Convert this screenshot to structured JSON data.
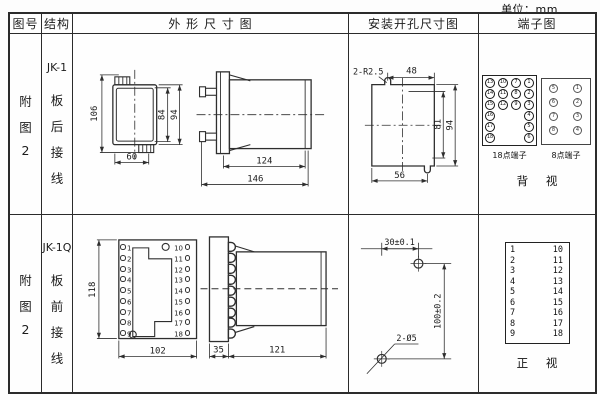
{
  "unit_note": "单位：mm",
  "colors": {
    "line": "#2b2b2b",
    "paper": "#fdfdfd"
  },
  "header": {
    "fig": "图号",
    "structure": "结构",
    "outline": "外 形 尺 寸 图",
    "mounting": "安装开孔尺寸图",
    "terminal": "端子图"
  },
  "rows": [
    {
      "fig_no": [
        "附",
        "图",
        "2"
      ],
      "structure": [
        "JK-1",
        "板",
        "后",
        "接",
        "线"
      ],
      "outline_dims": {
        "total_h": "106",
        "inner_h": "84",
        "outer_h": "94",
        "width": "60",
        "body_len": "124",
        "total_len": "146"
      },
      "mount_dims": {
        "notch": "2-R2.5",
        "top_w": "48",
        "inner_h": "81",
        "outer_h": "94",
        "bottom_w": "56"
      },
      "terminals18": {
        "caption": "18点端子",
        "items": [
          {
            "label": "13",
            "x": 6,
            "y": 44
          },
          {
            "label": "10",
            "x": 19,
            "y": 44
          },
          {
            "label": "7",
            "x": 32,
            "y": 44
          },
          {
            "label": "1",
            "x": 45,
            "y": 44
          },
          {
            "label": "14",
            "x": 6,
            "y": 55
          },
          {
            "label": "11",
            "x": 19,
            "y": 55
          },
          {
            "label": "8",
            "x": 32,
            "y": 55
          },
          {
            "label": "2",
            "x": 45,
            "y": 55
          },
          {
            "label": "15",
            "x": 6,
            "y": 66
          },
          {
            "label": "12",
            "x": 19,
            "y": 66
          },
          {
            "label": "9",
            "x": 32,
            "y": 66
          },
          {
            "label": "3",
            "x": 45,
            "y": 66
          },
          {
            "label": "16",
            "x": 6,
            "y": 77
          },
          {
            "label": "4",
            "x": 45,
            "y": 77
          },
          {
            "label": "17",
            "x": 6,
            "y": 88
          },
          {
            "label": "5",
            "x": 45,
            "y": 88
          },
          {
            "label": "18",
            "x": 6,
            "y": 99
          },
          {
            "label": "6",
            "x": 45,
            "y": 99
          }
        ]
      },
      "terminals8": {
        "caption": "8点端子",
        "items": [
          {
            "label": "5",
            "x": 70,
            "y": 50
          },
          {
            "label": "1",
            "x": 94,
            "y": 50
          },
          {
            "label": "6",
            "x": 70,
            "y": 64
          },
          {
            "label": "2",
            "x": 94,
            "y": 64
          },
          {
            "label": "7",
            "x": 70,
            "y": 78
          },
          {
            "label": "3",
            "x": 94,
            "y": 78
          },
          {
            "label": "8",
            "x": 70,
            "y": 92
          },
          {
            "label": "4",
            "x": 94,
            "y": 92
          }
        ]
      },
      "view_label": "背 视"
    },
    {
      "fig_no": [
        "附",
        "图",
        "2"
      ],
      "structure": [
        "JK-1Q",
        "板",
        "前",
        "接",
        "线"
      ],
      "outline_dims": {
        "height": "118",
        "width": "102",
        "flange": "35",
        "body_len": "121"
      },
      "front_left_terms": [
        {
          "label": "1",
          "x": 47,
          "y": 29
        },
        {
          "label": "2",
          "x": 47,
          "y": 40
        },
        {
          "label": "3",
          "x": 47,
          "y": 51
        },
        {
          "label": "4",
          "x": 47,
          "y": 61
        },
        {
          "label": "5",
          "x": 47,
          "y": 72
        },
        {
          "label": "6",
          "x": 47,
          "y": 83
        },
        {
          "label": "7",
          "x": 47,
          "y": 94
        },
        {
          "label": "8",
          "x": 47,
          "y": 104
        },
        {
          "label": "9",
          "x": 47,
          "y": 115
        }
      ],
      "front_right_terms": [
        {
          "label": "10",
          "x": 100,
          "y": 29
        },
        {
          "label": "11",
          "x": 100,
          "y": 40
        },
        {
          "label": "12",
          "x": 100,
          "y": 51
        },
        {
          "label": "13",
          "x": 100,
          "y": 61
        },
        {
          "label": "14",
          "x": 100,
          "y": 72
        },
        {
          "label": "15",
          "x": 100,
          "y": 83
        },
        {
          "label": "16",
          "x": 100,
          "y": 94
        },
        {
          "label": "17",
          "x": 100,
          "y": 104
        },
        {
          "label": "18",
          "x": 100,
          "y": 115
        }
      ],
      "mount_dims": {
        "h_offset": "30±0.1",
        "v_offset": "100±0.2",
        "holes": "2-Ø5"
      },
      "terminal_left": [
        {
          "label": "1",
          "x": 31,
          "y": 31
        },
        {
          "label": "2",
          "x": 31,
          "y": 42
        },
        {
          "label": "3",
          "x": 31,
          "y": 52
        },
        {
          "label": "4",
          "x": 31,
          "y": 63
        },
        {
          "label": "5",
          "x": 31,
          "y": 73
        },
        {
          "label": "6",
          "x": 31,
          "y": 84
        },
        {
          "label": "7",
          "x": 31,
          "y": 94
        },
        {
          "label": "8",
          "x": 31,
          "y": 105
        },
        {
          "label": "9",
          "x": 31,
          "y": 115
        }
      ],
      "terminal_right": [
        {
          "label": "10",
          "x": 64,
          "y": 31
        },
        {
          "label": "11",
          "x": 64,
          "y": 42
        },
        {
          "label": "12",
          "x": 64,
          "y": 52
        },
        {
          "label": "13",
          "x": 64,
          "y": 63
        },
        {
          "label": "14",
          "x": 64,
          "y": 73
        },
        {
          "label": "15",
          "x": 64,
          "y": 84
        },
        {
          "label": "16",
          "x": 64,
          "y": 94
        },
        {
          "label": "17",
          "x": 64,
          "y": 105
        },
        {
          "label": "18",
          "x": 64,
          "y": 115
        }
      ],
      "view_label": "正 视"
    }
  ]
}
